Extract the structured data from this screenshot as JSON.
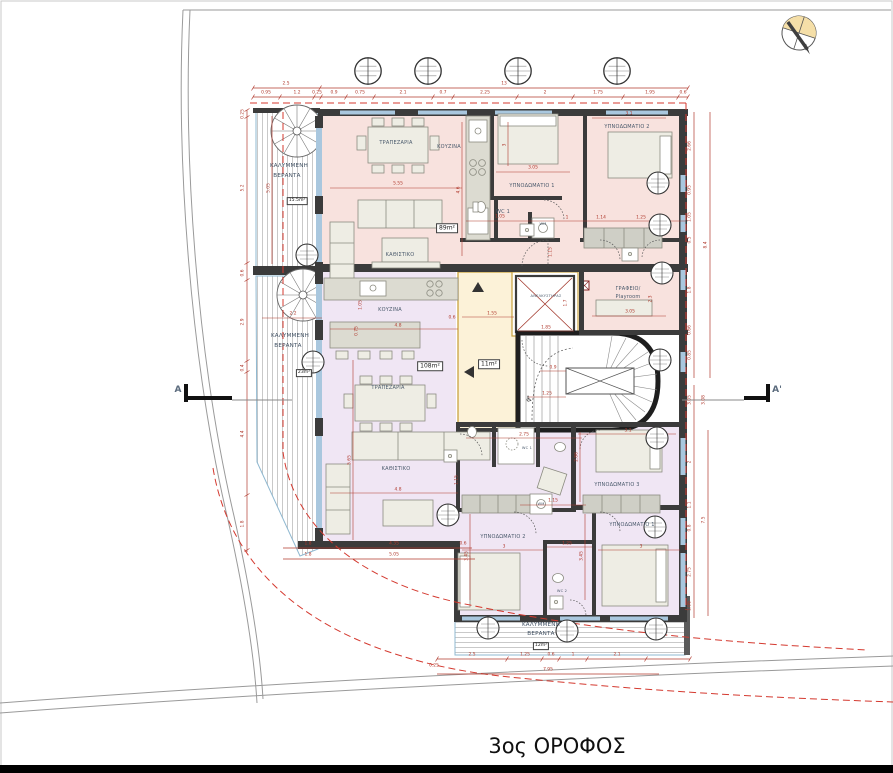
{
  "title": "3ος ΟΡΟΦΟΣ",
  "section": {
    "left": "A",
    "right": "A'"
  },
  "icons": {
    "wheelchair": "♿"
  },
  "apartment_top": {
    "area": "89m²",
    "dining": "ΤΡΑΠΕΖΑΡΙΑ",
    "kitchen": "ΚΟΥΖΙΝΑ",
    "living": "ΚΑΘΙΣΤΙΚΟ",
    "bedroom1": "ΥΠΝΟΔΩΜΑΤΙΟ 1",
    "bedroom2": "ΥΠΝΟΔΩΜΑΤΙΟ 2",
    "wc": "WC 1",
    "wm": "WM",
    "office_line1": "ΓΡΑΦΕΙΟ/",
    "office_line2": "Playroom"
  },
  "apartment_bottom": {
    "area": "108m²",
    "kitchen": "ΚΟΥΖΙΝΑ",
    "dining": "ΤΡΑΠΕΖΑΡΙΑ",
    "living": "ΚΑΘΙΣΤΙΚΟ",
    "bedroom1": "ΥΠΝΟΔΩΜΑΤΙΟ 1",
    "bedroom2": "ΥΠΝΟΔΩΜΑΤΙΟ 2",
    "bedroom3": "ΥΠΝΟΔΩΜΑΤΙΟ 3",
    "wc1": "WC 1",
    "wc2": "WC 2",
    "wm": "WM"
  },
  "core": {
    "elevator": "ΑΝΕΛΚΥΣΤΗΡΑΣ",
    "lobby_area": "11m²"
  },
  "verandas": {
    "word1": "ΚΑΛΥΜΜΕΝΗ",
    "word2": "ΒΕΡΑΝΤΑ",
    "top_area": "15.5m²",
    "mid_area": "23m²",
    "bottom_area": "12m²"
  },
  "dims": {
    "t1": [
      "2.5",
      "13"
    ],
    "t2": [
      "0.95",
      "1.2",
      "0.25",
      "0.9",
      "0.75",
      "2.1",
      "0.7",
      "2.25",
      "2",
      "1.75",
      "1.95",
      "0.6"
    ],
    "b": [
      "2.5",
      "1.25",
      "0.6",
      "1",
      "2.1"
    ],
    "bt": "7.95",
    "bls": "0.25",
    "bl1": [
      "1.8",
      "4.35",
      "0.6"
    ],
    "bl2": [
      "1.8",
      "5.05"
    ],
    "l": [
      "0.25",
      "5.2",
      "0.6",
      "2.9",
      "0.4",
      "4.4",
      "1.8"
    ],
    "li": "5.05",
    "r1": [
      "2.66",
      "0.95",
      "1.05",
      "0.5",
      "1.8",
      "0.66",
      "0.85"
    ],
    "rt": "8.4",
    "rm": [
      "3.05",
      "3.08"
    ],
    "r2": [
      "2",
      "1.1",
      "0.8",
      "2.75",
      "1.06"
    ],
    "r2t": "7.5",
    "in": [
      "5.55",
      "4.6",
      "3.05",
      "3",
      "3.1",
      "2.3",
      "3.05",
      "1.05",
      "1",
      "1.14",
      "1.25",
      "1.15",
      "1.55",
      "1.85",
      "1.7",
      "0.9",
      "1.25",
      "4.8",
      "1.05",
      "0.75",
      "0.6",
      "5.65",
      "4.8",
      "1.15",
      "2.75",
      "1.15",
      "3.45",
      "3.45",
      "1.25",
      "3",
      "3",
      "3.1",
      "2.86",
      "2.2"
    ]
  },
  "colors": {
    "apartment_top_fill": "#f8e2de",
    "apartment_bottom_fill": "#f0e6f4",
    "lobby_fill": "#fcf2d8",
    "lobby_border": "#c9a23f",
    "wall": "#3b3b3b",
    "window": "#a9c7de",
    "dimension": "#b03a2e",
    "setback_dashed": "#d4392f",
    "site_line": "#9a9a9a"
  }
}
